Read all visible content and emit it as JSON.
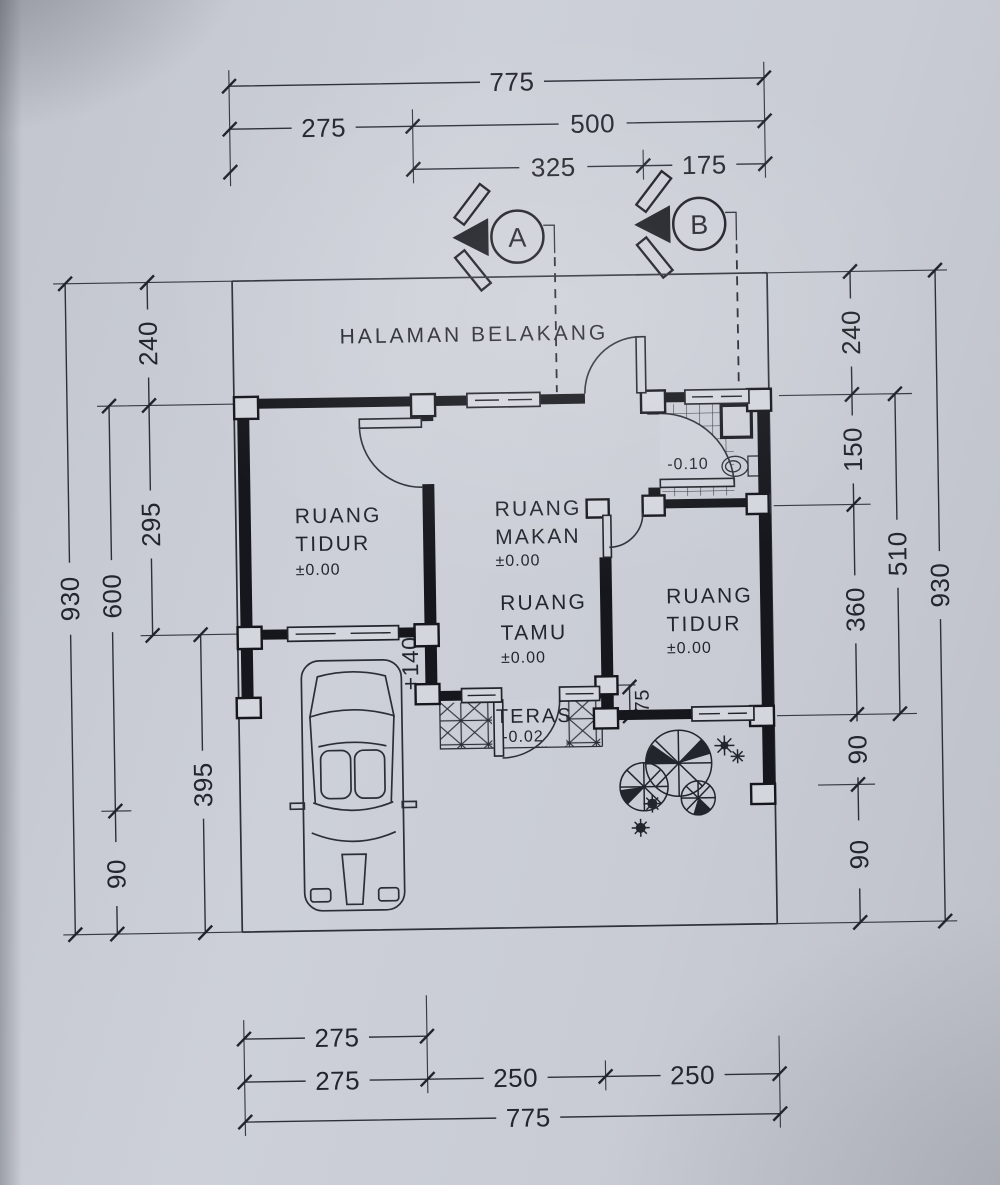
{
  "drawing": {
    "backyard_label": "HALAMAN BELAKANG",
    "rooms": {
      "bedroom_left": {
        "line1": "RUANG",
        "line2": "TIDUR",
        "level": "±0.00"
      },
      "dining": {
        "line1": "RUANG",
        "line2": "MAKAN",
        "level": "±0.00"
      },
      "living": {
        "line1": "RUANG",
        "line2": "TAMU",
        "level": "±0.00"
      },
      "bedroom_right": {
        "line1": "RUANG",
        "line2": "TIDUR",
        "level": "±0.00"
      },
      "terrace": {
        "name": "TERAS",
        "level": "-0.02"
      },
      "bathroom": {
        "level": "-0.10"
      }
    },
    "sections": {
      "a": "A",
      "b": "B"
    },
    "dims": {
      "top": {
        "total": "775",
        "left": "275",
        "right": "500",
        "mid": "325",
        "end": "175"
      },
      "bottom": {
        "row1": "275",
        "left": "275",
        "mid": "250",
        "right": "250",
        "total": "775"
      },
      "left": {
        "outer": "930",
        "mid_upper": "600",
        "mid_lower": "90",
        "top": "240",
        "middle": "295",
        "bottom": "395"
      },
      "right": {
        "outer": "930",
        "mid": "510",
        "top": "240",
        "upper": "150",
        "middle": "360",
        "lower": "90",
        "bottom": "90"
      },
      "floor": {
        "step": "+140",
        "teras_gap": "75"
      }
    },
    "ink_color": "#15171c",
    "paper_color": "#c9ccd4"
  }
}
